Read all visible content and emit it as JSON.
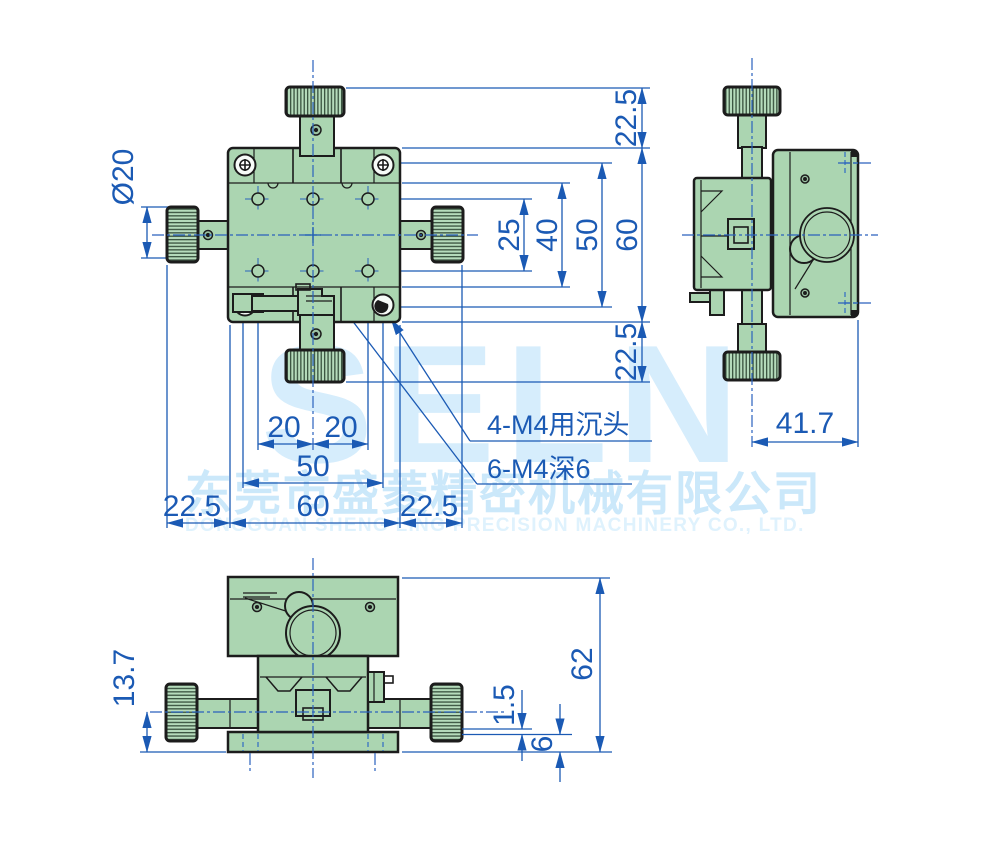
{
  "watermark": {
    "logo": "SELN",
    "company_cn": "东莞市盛菱精密机械有限公司",
    "company_en": "DONGGUAN SHENG LING PRECISION MACHINERY CO., LTD."
  },
  "colors": {
    "outline": "#1c1c1c",
    "dimension_blue": "#1b5ab4",
    "body_green": "#abd5b1",
    "watermark_blue": "#d6edfc"
  },
  "plan_view": {
    "dims": {
      "knob_diameter": "Ø20",
      "top_knob_offset": "22.5",
      "hole_row_spacing": "25",
      "plate_height": "40",
      "screw_spacing_vertical": "50",
      "body_height": "60",
      "bottom_knob_offset": "22.5",
      "hole_col_left": "20",
      "hole_col_right": "20",
      "screw_spacing_horizontal": "50",
      "left_knob_offset": "22.5",
      "body_width": "60",
      "right_knob_offset": "22.5"
    },
    "callouts": {
      "counterbore_holes": "4-M4用沉头",
      "tapped_holes": "6-M4深6"
    }
  },
  "side_view": {
    "dims": {
      "body_depth": "41.7"
    }
  },
  "front_view": {
    "dims": {
      "knob_center_height": "13.7",
      "total_height": "62",
      "base_clearance": "1.5",
      "base_thickness": "6"
    }
  }
}
